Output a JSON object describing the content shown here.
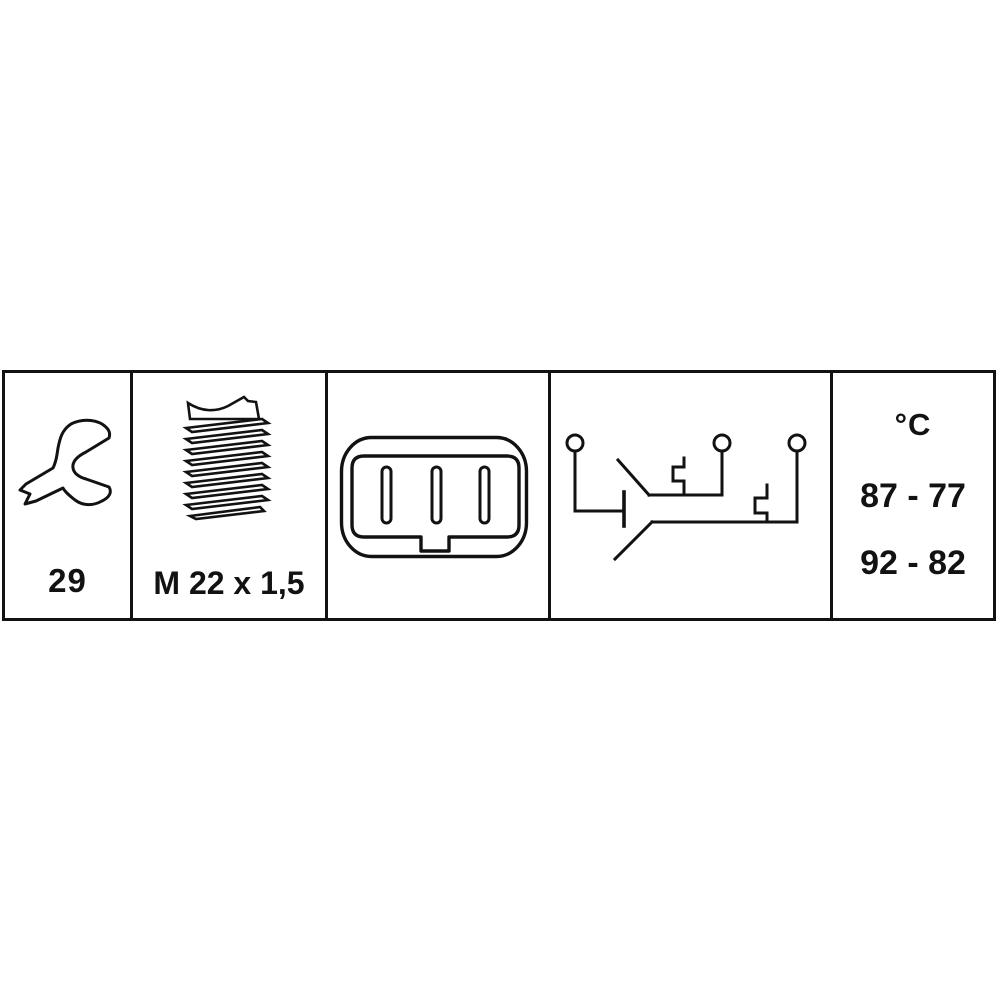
{
  "image": {
    "type": "auto-part-pictogram-strip",
    "background_color": "#ffffff",
    "line_color": "#121212"
  },
  "panels": {
    "wrench": {
      "icon": "open-end-wrench-icon",
      "label": "29"
    },
    "thread": {
      "icon": "threaded-stud-icon",
      "label": "M 22 x 1,5"
    },
    "connector": {
      "icon": "three-pin-connector-icon"
    },
    "circuit": {
      "icon": "thermo-switch-circuit-icon",
      "terminal_count": "3"
    },
    "temperature": {
      "unit_label": "°C",
      "range_high": "87 - 77",
      "range_low": "92 - 82"
    }
  }
}
